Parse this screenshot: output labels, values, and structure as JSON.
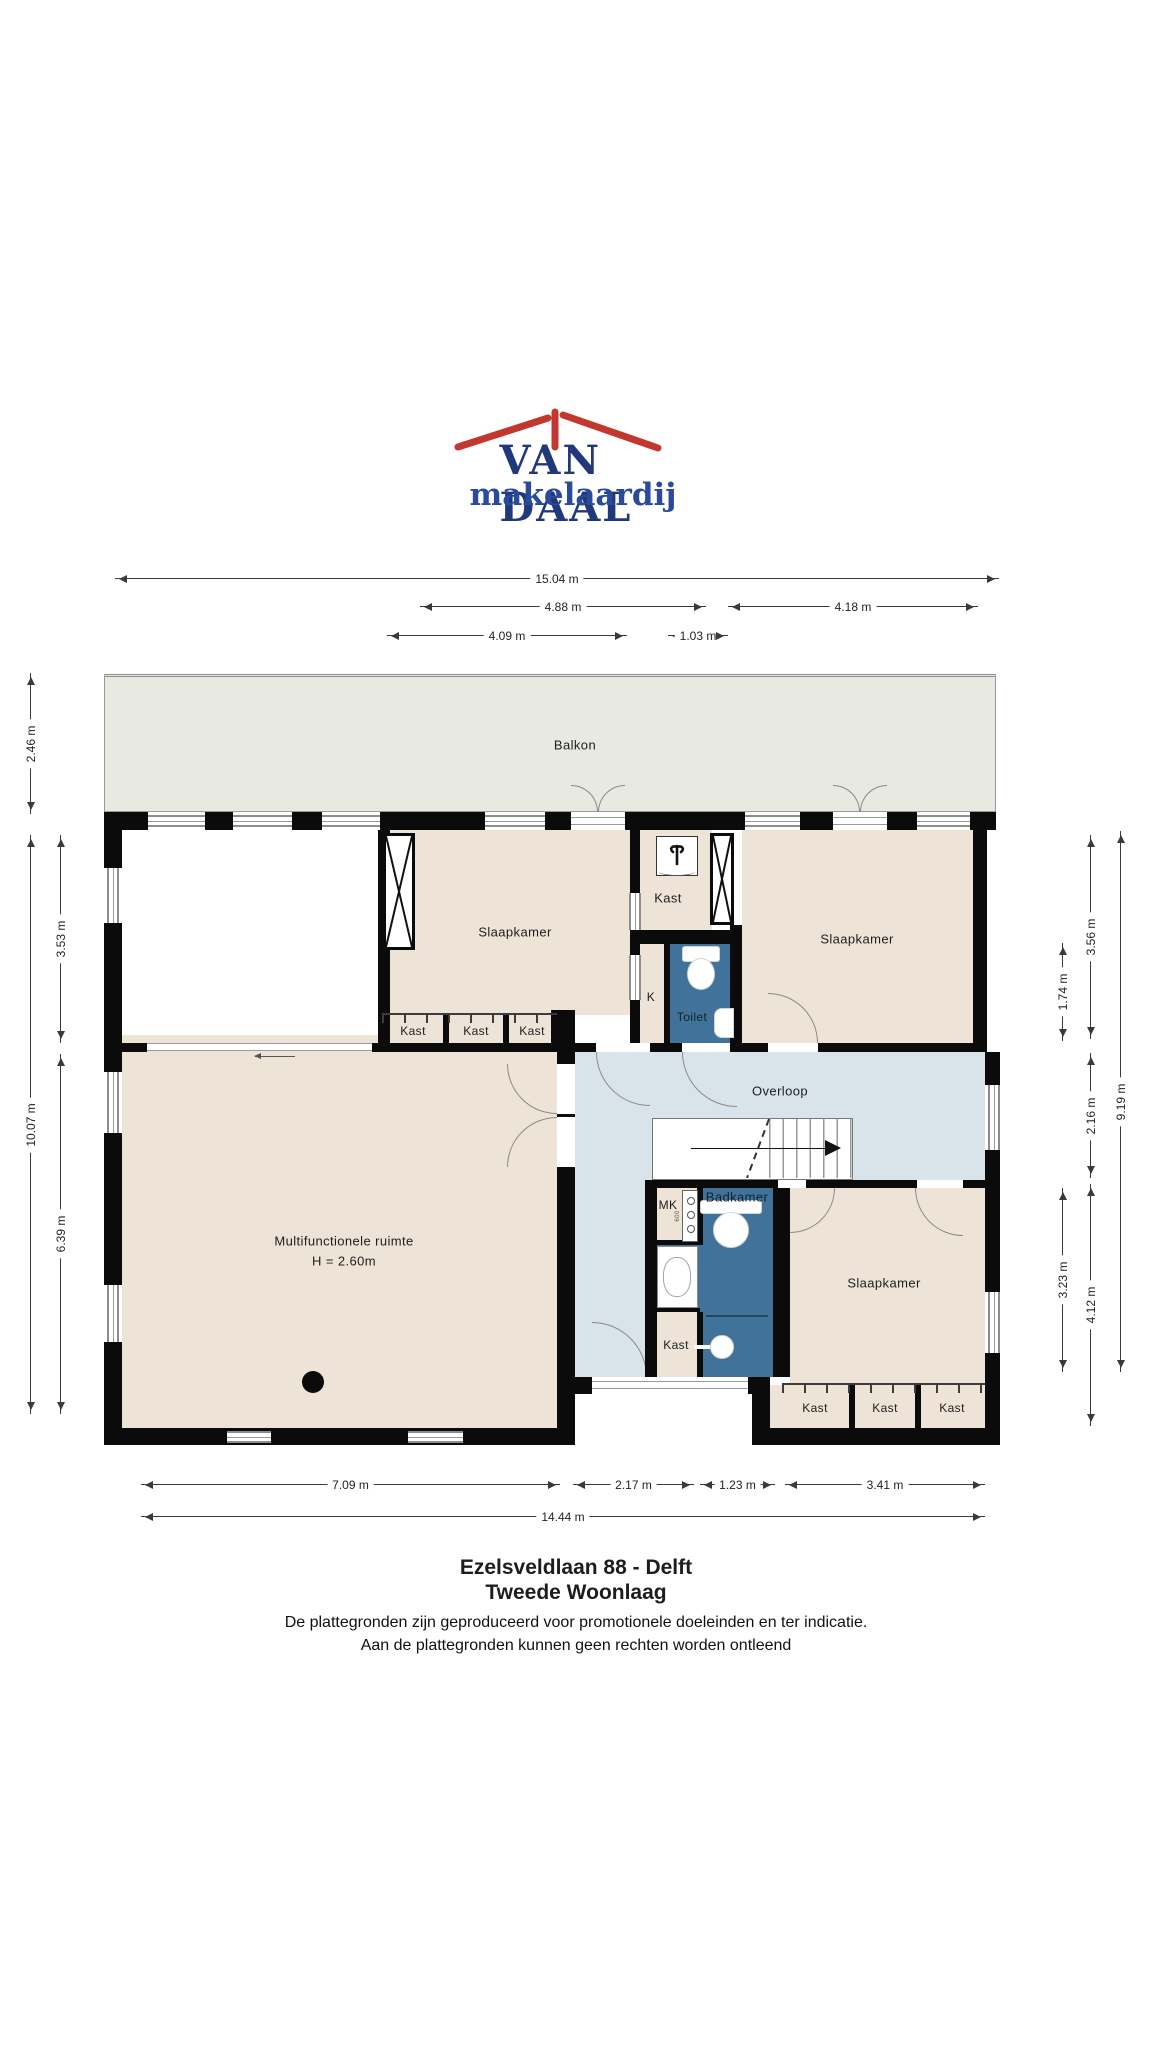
{
  "logo": {
    "name": "VAN DAAL",
    "tagline": "makelaardij"
  },
  "colors": {
    "wall": "#0b0b0b",
    "room_beige": "#EDE4D7",
    "balcony_grey": "#E8EAE2",
    "hall_blue": "#D8E4E9",
    "wet_blue": "#41739A",
    "logo_red": "#C2372E",
    "logo_blue": "#21397B"
  },
  "rooms": {
    "balkon": "Balkon",
    "slaapkamer_left": "Slaapkamer",
    "kast_top": "Kast",
    "k": "K",
    "toilet": "Toilet",
    "slaapkamer_right": "Slaapkamer",
    "overloop": "Overloop",
    "multifunctioneel_line1": "Multifunctionele ruimte",
    "multifunctioneel_line2": "H = 2.60m",
    "mk": "MK",
    "badkamer": "Badkamer",
    "kast_mid": "Kast",
    "slaapkamer_bottom": "Slaapkamer",
    "kast_row_top": [
      "Kast",
      "Kast",
      "Kast"
    ],
    "kast_row_bottom": [
      "Kast",
      "Kast",
      "Kast"
    ],
    "meter_value": "600"
  },
  "dimensions": {
    "top": [
      "15.04 m",
      "4.88 m",
      "4.18 m",
      "4.09 m",
      "1.03 m"
    ],
    "bottom": [
      "7.09 m",
      "2.17 m",
      "1.23 m",
      "3.41 m",
      "14.44 m"
    ],
    "left": [
      "2.46 m",
      "10.07 m",
      "3.53 m",
      "6.39 m"
    ],
    "right": [
      "1.74 m",
      "3.23 m",
      "3.56 m",
      "2.16 m",
      "4.12 m",
      "9.19 m"
    ]
  },
  "footer": {
    "title": "Ezelsveldlaan 88 - Delft",
    "subtitle": "Tweede Woonlaag",
    "disclaimer_line1": "De plattegronden zijn geproduceerd voor promotionele doeleinden en ter indicatie.",
    "disclaimer_line2": "Aan de plattegronden kunnen geen rechten worden ontleend"
  }
}
